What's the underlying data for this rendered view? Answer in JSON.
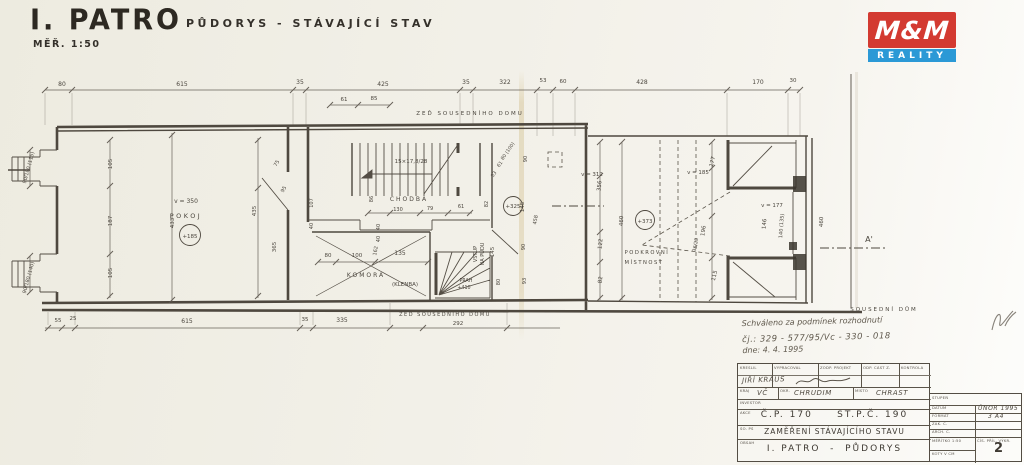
{
  "header": {
    "title": "I. PATRO",
    "subtitle": "PŮDORYS  -  STÁVAJÍCÍ STAV",
    "scale": "MĚŘ. 1:50"
  },
  "logo": {
    "top": "M&M",
    "bottom": "REALITY",
    "red": "#d33a31",
    "blue": "#2b99d6"
  },
  "stamp": {
    "line1": "Schváleno za podmínek rozhodnutí",
    "line2": "čj.: 329 - 577/95/Vc - 330 - 018",
    "line3": "dne:  4. 4. 1995"
  },
  "titleblock": {
    "row1": [
      "KRESLIL",
      "VYPRACOVAL",
      "ZODP. PROJEKT",
      "ODP. ČÁST Z.",
      "KONTROLA"
    ],
    "drafter": "JIŘÍ KRAUS",
    "region_label": "KRAJ",
    "region": "VČ",
    "district_label": "OKR.",
    "district": "CHRUDIM",
    "place_label": "MÍSTO",
    "place": "CHRAST",
    "investor_label": "INVESTOR",
    "akce_label": "AKCE",
    "akce": "Č.P. 170     ST.P.Č. 190",
    "so_label": "SO. PS",
    "so": "ZAMĚŘENÍ STÁVAJÍCÍHO STAVU",
    "obsah_label": "OBSAH",
    "obsah": "I. PATRO  -  PŮDORYS",
    "stupen_label": "STUPEŇ",
    "datum_label": "DATUM",
    "datum": "ÚNOR 1995",
    "format_label": "FORMÁT",
    "format": "3 A4",
    "zak_label": "ZAK. Č.",
    "arch_label": "ARCH. Č.",
    "meritko": "MĚŘÍTKO  1:50",
    "koty": "KÓTY V CM",
    "cis_label": "ČÍS. PŘÍL. VÝKR.",
    "cis": "2"
  },
  "plan": {
    "labels": [
      {
        "t": "80",
        "x": 62,
        "y": 86,
        "s": 6
      },
      {
        "t": "615",
        "x": 182,
        "y": 86,
        "s": 6
      },
      {
        "t": "35",
        "x": 300,
        "y": 84,
        "s": 6
      },
      {
        "t": "425",
        "x": 383,
        "y": 86,
        "s": 6
      },
      {
        "t": "35",
        "x": 466,
        "y": 84,
        "s": 6
      },
      {
        "t": "322",
        "x": 505,
        "y": 84,
        "s": 6
      },
      {
        "t": "53",
        "x": 543,
        "y": 82,
        "s": 5.5
      },
      {
        "t": "60",
        "x": 563,
        "y": 83,
        "s": 5.5
      },
      {
        "t": "428",
        "x": 642,
        "y": 84,
        "s": 6
      },
      {
        "t": "170",
        "x": 758,
        "y": 84,
        "s": 6
      },
      {
        "t": "30",
        "x": 793,
        "y": 82,
        "s": 5.5
      },
      {
        "t": "61",
        "x": 344,
        "y": 101,
        "s": 5.5
      },
      {
        "t": "85",
        "x": 374,
        "y": 100,
        "s": 5.5
      },
      {
        "t": "ZEĎ SOUSEDNÍHO DOMU",
        "x": 470,
        "y": 115,
        "s": 5.5,
        "ls": 2
      },
      {
        "t": "55",
        "x": 58,
        "y": 322,
        "s": 5.5
      },
      {
        "t": "25",
        "x": 73,
        "y": 320,
        "s": 5.5
      },
      {
        "t": "615",
        "x": 187,
        "y": 323,
        "s": 6
      },
      {
        "t": "35",
        "x": 305,
        "y": 321,
        "s": 5.5
      },
      {
        "t": "335",
        "x": 342,
        "y": 322,
        "s": 6
      },
      {
        "t": "ZEĎ SOUSEDNÍHO DOMU",
        "x": 445,
        "y": 316,
        "s": 5,
        "ls": 1.5
      },
      {
        "t": "292",
        "x": 458,
        "y": 325,
        "s": 5.5
      },
      {
        "t": "90/180 (115)",
        "x": 30,
        "y": 168,
        "r": -75,
        "s": 5
      },
      {
        "t": "90/180 (140)",
        "x": 30,
        "y": 278,
        "r": -75,
        "s": 5
      },
      {
        "t": "v = 350",
        "x": 186,
        "y": 203,
        "s": 6
      },
      {
        "t": "POKOJ",
        "x": 186,
        "y": 218,
        "s": 6.5,
        "ls": 2.5
      },
      {
        "t": "+185",
        "x": 190,
        "y": 238,
        "s": 5.5
      },
      {
        "t": "105",
        "x": 112,
        "y": 164,
        "r": -90,
        "s": 5.5
      },
      {
        "t": "187",
        "x": 112,
        "y": 221,
        "r": -90,
        "s": 5.5
      },
      {
        "t": "105",
        "x": 112,
        "y": 273,
        "r": -90,
        "s": 5.5
      },
      {
        "t": "433",
        "x": 174,
        "y": 223,
        "r": -90,
        "s": 5.5
      },
      {
        "t": "435",
        "x": 256,
        "y": 211,
        "r": -90,
        "s": 5.5
      },
      {
        "t": "365",
        "x": 276,
        "y": 247,
        "r": -90,
        "s": 5.5
      },
      {
        "t": "75",
        "x": 278,
        "y": 164,
        "r": -60,
        "s": 5
      },
      {
        "t": "95",
        "x": 285,
        "y": 190,
        "r": -60,
        "s": 5
      },
      {
        "t": "107",
        "x": 313,
        "y": 203,
        "r": -90,
        "s": 5
      },
      {
        "t": "40",
        "x": 313,
        "y": 226,
        "r": -90,
        "s": 5
      },
      {
        "t": "15×17,8/28",
        "x": 411,
        "y": 163,
        "s": 5.5
      },
      {
        "t": "CHODBA",
        "x": 409,
        "y": 201,
        "s": 6,
        "ls": 2
      },
      {
        "t": "130",
        "x": 398,
        "y": 211,
        "s": 5
      },
      {
        "t": "79",
        "x": 430,
        "y": 210,
        "s": 5
      },
      {
        "t": "61",
        "x": 461,
        "y": 208,
        "s": 5
      },
      {
        "t": "86",
        "x": 373,
        "y": 199,
        "r": -90,
        "s": 5
      },
      {
        "t": "KOMORA",
        "x": 366,
        "y": 277,
        "s": 6,
        "ls": 2
      },
      {
        "t": "(KLENBA)",
        "x": 405,
        "y": 286,
        "s": 5.5
      },
      {
        "t": "80",
        "x": 328,
        "y": 257,
        "s": 5.5
      },
      {
        "t": "100",
        "x": 357,
        "y": 257,
        "s": 5.5
      },
      {
        "t": "135",
        "x": 400,
        "y": 255,
        "s": 6
      },
      {
        "t": "162",
        "x": 377,
        "y": 251,
        "r": -80,
        "s": 5
      },
      {
        "t": "40",
        "x": 380,
        "y": 227,
        "r": -90,
        "s": 5
      },
      {
        "t": "40",
        "x": 380,
        "y": 239,
        "r": -90,
        "s": 5
      },
      {
        "t": "VSTUP",
        "x": 477,
        "y": 254,
        "r": -90,
        "s": 5
      },
      {
        "t": "NA PŮDU",
        "x": 484,
        "y": 254,
        "r": -90,
        "s": 5
      },
      {
        "t": "145",
        "x": 494,
        "y": 252,
        "r": -90,
        "s": 5.5
      },
      {
        "t": "PRAH",
        "x": 466,
        "y": 282,
        "s": 4.8
      },
      {
        "t": "+410",
        "x": 464,
        "y": 289,
        "s": 4.8
      },
      {
        "t": "80",
        "x": 500,
        "y": 282,
        "r": -90,
        "s": 5
      },
      {
        "t": "+325",
        "x": 513,
        "y": 208,
        "s": 5.5
      },
      {
        "t": "82",
        "x": 488,
        "y": 204,
        "r": -90,
        "s": 5
      },
      {
        "t": "145",
        "x": 524,
        "y": 207,
        "r": -90,
        "s": 5.5
      },
      {
        "t": "458",
        "x": 537,
        "y": 220,
        "r": -80,
        "s": 5
      },
      {
        "t": "90",
        "x": 527,
        "y": 159,
        "r": -90,
        "s": 5
      },
      {
        "t": "90",
        "x": 525,
        "y": 247,
        "r": -90,
        "s": 5
      },
      {
        "t": "93",
        "x": 526,
        "y": 281,
        "r": -90,
        "s": 5
      },
      {
        "t": "53",
        "x": 495,
        "y": 175,
        "r": -55,
        "s": 4.8
      },
      {
        "t": "61",
        "x": 501,
        "y": 165,
        "r": -55,
        "s": 4.8
      },
      {
        "t": "80 (100)",
        "x": 509,
        "y": 152,
        "r": -55,
        "s": 4.8
      },
      {
        "t": "v = 312",
        "x": 592,
        "y": 176,
        "s": 5.5
      },
      {
        "t": "356",
        "x": 601,
        "y": 186,
        "r": -84,
        "s": 5.5
      },
      {
        "t": "122",
        "x": 602,
        "y": 244,
        "r": -84,
        "s": 5.5
      },
      {
        "t": "82",
        "x": 602,
        "y": 280,
        "r": -84,
        "s": 5.5
      },
      {
        "t": "460",
        "x": 623,
        "y": 221,
        "r": -88,
        "s": 5.5
      },
      {
        "t": "+373",
        "x": 645,
        "y": 223,
        "s": 5.5
      },
      {
        "t": "PODKROVNÍ",
        "x": 647,
        "y": 254,
        "s": 5.2,
        "ls": 1.5
      },
      {
        "t": "MÍSTNOST",
        "x": 644,
        "y": 264,
        "s": 5.2,
        "ls": 1.5
      },
      {
        "t": "v = 185",
        "x": 698,
        "y": 174,
        "s": 5.5
      },
      {
        "t": "177",
        "x": 714,
        "y": 162,
        "r": -76,
        "s": 5.5
      },
      {
        "t": "196",
        "x": 705,
        "y": 231,
        "r": -82,
        "s": 5.5
      },
      {
        "t": "36/23",
        "x": 697,
        "y": 245,
        "r": -80,
        "s": 4.8
      },
      {
        "t": "115",
        "x": 716,
        "y": 276,
        "r": -76,
        "s": 5.5
      },
      {
        "t": "v = 177",
        "x": 772,
        "y": 207,
        "s": 5.5
      },
      {
        "t": "146",
        "x": 766,
        "y": 224,
        "r": -86,
        "s": 5.5
      },
      {
        "t": "140 (135)",
        "x": 783,
        "y": 226,
        "r": -86,
        "s": 5
      },
      {
        "t": "460",
        "x": 823,
        "y": 222,
        "r": -88,
        "s": 5.5
      },
      {
        "t": "A'",
        "x": 869,
        "y": 242,
        "s": 8
      },
      {
        "t": "SOUSEDNÍ DŮM",
        "x": 884,
        "y": 311,
        "s": 5.5,
        "ls": 2
      }
    ]
  }
}
